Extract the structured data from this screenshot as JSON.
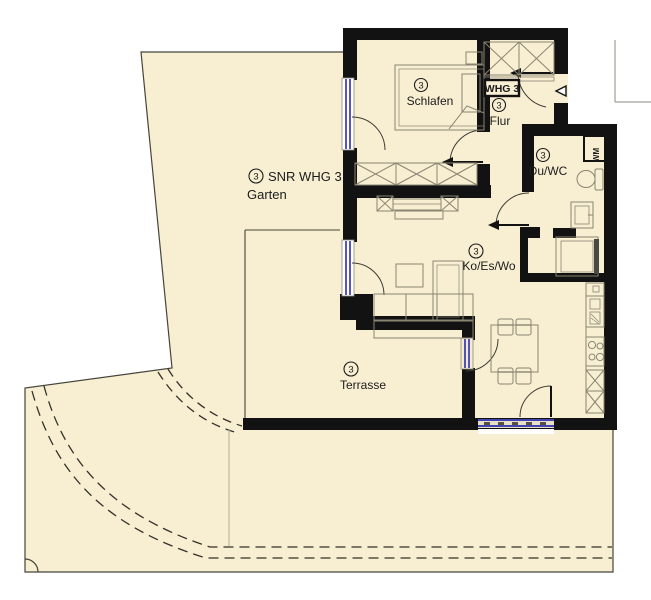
{
  "plan": {
    "title": "Floor plan apartment WHG 3",
    "unit_box_label": "WHG 3",
    "rooms": {
      "schlafen": {
        "number": "3",
        "name": "Schlafen"
      },
      "flur": {
        "number": "3",
        "name": "Flur"
      },
      "duwc": {
        "number": "3",
        "name": "Du/WC"
      },
      "koeswo": {
        "number": "3",
        "name": "Ko/Es/Wo"
      },
      "terrasse": {
        "number": "3",
        "name": "Terrasse"
      },
      "garten": {
        "number": "3",
        "name_line1": "SNR WHG 3",
        "name_line2": "Garten"
      }
    },
    "appliances": {
      "washing_machine": "WM"
    },
    "colors": {
      "floor": "#f8efd3",
      "wall": "#121212",
      "window_blue": "#2b2bae",
      "furniture": "#8a8472",
      "boundary": "#45443a"
    }
  }
}
